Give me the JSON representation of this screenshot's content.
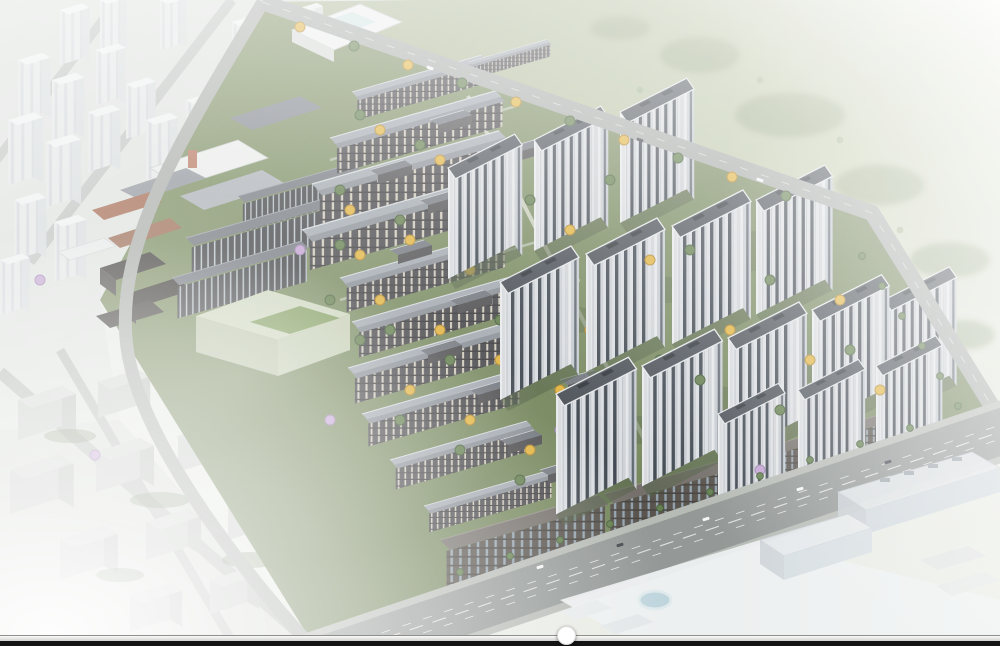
{
  "scene": {
    "type": "aerial-architectural-rendering",
    "description": "Bird's-eye masterplan rendering of a large residential development: diagonal rows of low-rise courtyard apartment blocks with green, yellow and purple trees on the left, a grid of white high-rise towers on the right, a retail village and pale-green massing block on the west edge, a wide boulevard with a dark mid-rise strip along the south, hazy white context city to the north-west, grey massing blocks to the south-west, foggy green fields to the north-east and faded office buildings to the south-east.",
    "regions": [
      {
        "name": "context-city-northwest"
      },
      {
        "name": "meadow-northeast"
      },
      {
        "name": "context-blocks-southwest"
      },
      {
        "name": "offices-southeast"
      },
      {
        "name": "retail-village-west"
      },
      {
        "name": "green-massing-block"
      },
      {
        "name": "midrise-dark-blocks"
      },
      {
        "name": "lowrise-courtyard-field"
      },
      {
        "name": "highrise-tower-grid"
      },
      {
        "name": "south-commercial-strip"
      },
      {
        "name": "boulevard-south"
      },
      {
        "name": "perimeter-roads"
      }
    ]
  },
  "palette": {
    "canvasBg": "#e7eae3",
    "meadowFar": "#dfe4d6",
    "meadowNear": "#a9b592",
    "siteGreen": "#74865a",
    "siteGreenDark": "#55653f",
    "roofLow": "#a0a7ae",
    "roofLowDark": "#878d94",
    "faceLowBg": "#434347",
    "towerFace": "#d9dce0",
    "towerWin": "#39414a",
    "towerSide": "#c4c9cf",
    "towerRoof": "#464c53",
    "treeGreen": "#5f7a48",
    "treeYellow": "#e0b23c",
    "treePurple": "#c2a0d1",
    "brick": "#a2674e",
    "greenCubeTop": "#ccd5bc",
    "greenCubeSide": "#b9c3a7",
    "asphalt": "#8f9492",
    "sidewalk": "#b4b8b2",
    "roadMinor": "#a5a9a6",
    "ctxGround": "#dde1dd",
    "ctxRoof": "#f0f2f2",
    "poolBlue": "#b9d2dc",
    "fogWhite": "#ffffff",
    "trackLine": "#8f8f8c",
    "trackTop": "#fbfbfa",
    "trackBottom": "#c8c8c5",
    "bottomBar": "#141414",
    "thumb": "#ffffff"
  },
  "ui": {
    "scrubber": {
      "thumb_left_px": "557px",
      "thumb_top_px": "626px"
    }
  }
}
